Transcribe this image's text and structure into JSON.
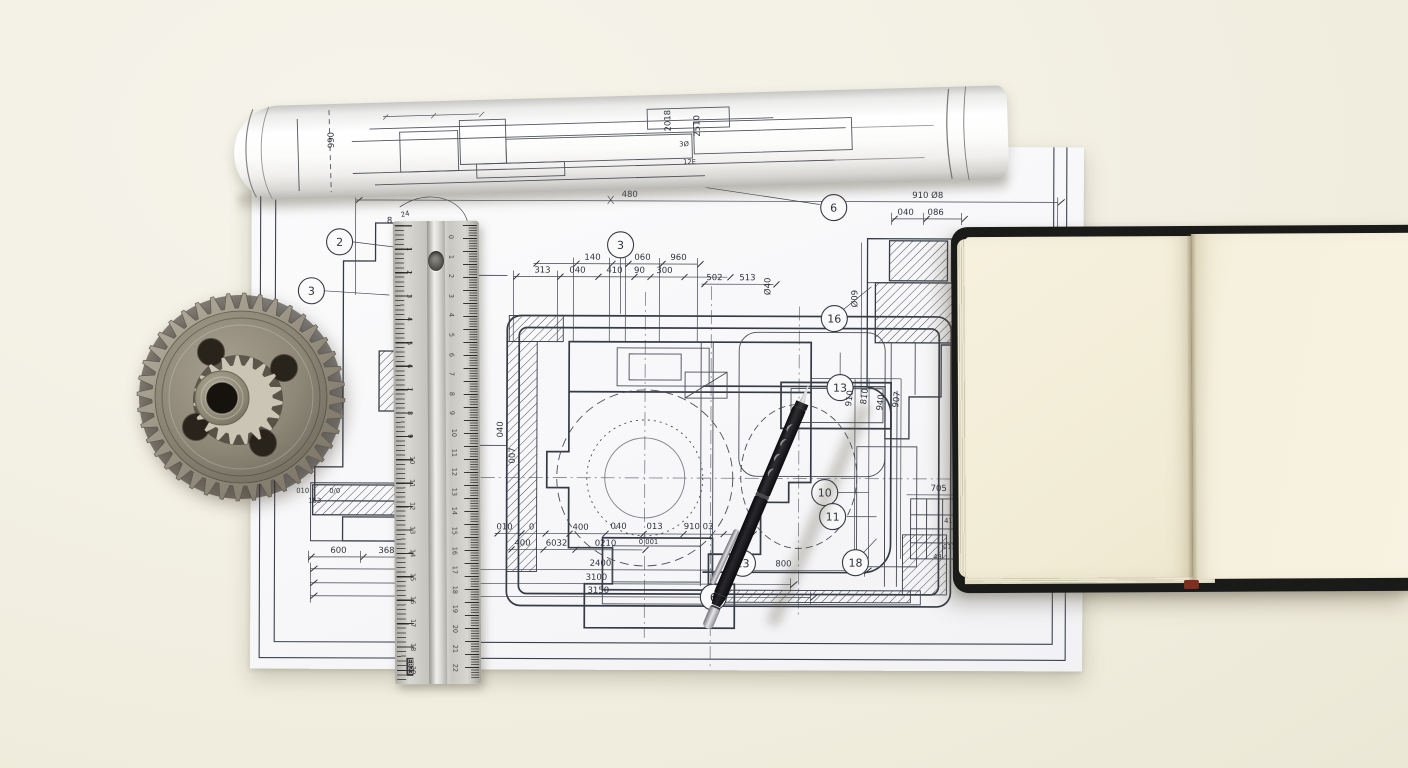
{
  "callouts": {
    "c2": "2",
    "c3a": "3",
    "c3b": "3",
    "c6a": "6",
    "c16": "16",
    "c13a": "13",
    "c10": "10",
    "c11": "11",
    "c18": "18",
    "c13b": "13",
    "c6b": "6"
  },
  "dims": {
    "top_total": "480",
    "top_shaft": "910 Ø8",
    "tr1": "040",
    "tr2": "086",
    "tr3": "810",
    "tr4": "Ø09",
    "row1": [
      "140",
      "060",
      "960"
    ],
    "row2": [
      "313",
      "040",
      "410",
      "90",
      "300"
    ],
    "pair": [
      "502",
      "513"
    ],
    "rot_mid": "Ø40",
    "left_rot": [
      "040",
      "007"
    ],
    "pen_rot": [
      "910",
      "810",
      "940",
      "907"
    ],
    "detail": "705",
    "detail_small": [
      "418",
      "013",
      "43"
    ],
    "b1": [
      "010",
      "0",
      "400",
      "040",
      "013",
      "910 03"
    ],
    "b1x": "0 001",
    "b2": [
      "400",
      "6032",
      "0210"
    ],
    "totals": [
      "2400",
      "3100",
      "3150"
    ],
    "b_right": "800",
    "lb": [
      "600",
      "368"
    ],
    "lb_small": [
      "010",
      "0/0",
      "163"
    ],
    "tiny_a": "8",
    "tiny_b": "24"
  },
  "roll": {
    "labels": [
      "990",
      "2018",
      "2510",
      "3Ø",
      "12E"
    ]
  },
  "ruler": {
    "left_numbers": [
      "1",
      "2",
      "3",
      "4",
      "5",
      "6",
      "7",
      "8",
      "9",
      "10",
      "11",
      "12",
      "13",
      "14",
      "15",
      "16",
      "17",
      "18",
      "19"
    ],
    "right_numbers": [
      "0",
      "1",
      "2",
      "3",
      "4",
      "5",
      "6",
      "7",
      "8",
      "9",
      "10",
      "11",
      "12",
      "13",
      "14",
      "15",
      "16",
      "17",
      "18",
      "19",
      "20",
      "21",
      "22"
    ],
    "brand": "EB23"
  }
}
